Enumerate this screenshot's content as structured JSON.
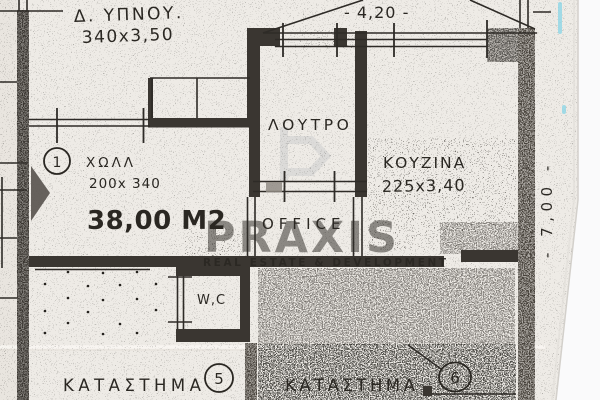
{
  "document": {
    "type": "scanned floor plan",
    "colors": {
      "paper": "#eeebe6",
      "ink": "#2a2722",
      "wall": "#3a3631",
      "wall_mottled": "#46413a",
      "watermark": "#c7c7c7",
      "watermark_tagline": "#a8a8a8",
      "scan_edge": "#fafafb",
      "highlighter_mark": "#8fd7e6"
    }
  },
  "plan": {
    "bedroom_label": "Δ. ΥΠΝΟΥ.",
    "bedroom_dims": "340x3,50",
    "dim_top": "- 4,20 -",
    "bathroom_label": "ΛΟΥΤΡΟ",
    "kitchen_label": "ΚΟΥΖΙΝΑ",
    "kitchen_dims": "225x3,40",
    "hall_number": "1",
    "hall_label": "ΧΩΛΛ",
    "hall_dims": "200x 340",
    "hall_area": "38,00 Μ2",
    "office_label": "OFFICE",
    "wc_label": "W,C",
    "shop5_label": "ΚΑΤΑΣΤΗΜΑ",
    "shop5_number": "5",
    "shop6_label": "ΚΑΤΑΣΤΗΜΑ",
    "shop6_number": "6",
    "dim_right": "- 7,00 -"
  },
  "watermark": {
    "name": "PRAXIS",
    "tagline": "REAL ESTATE & DEVELOPMENT"
  }
}
